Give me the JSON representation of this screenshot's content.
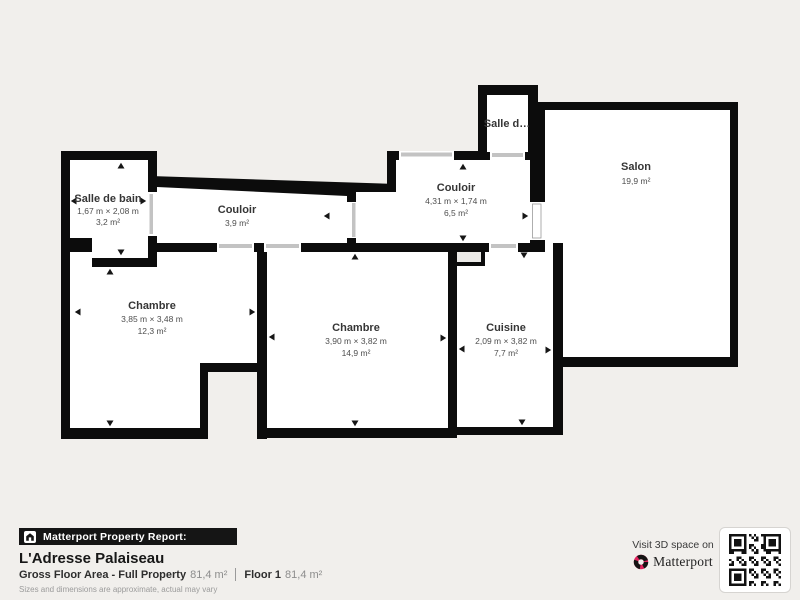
{
  "plan": {
    "rooms": {
      "salle_de_bain": {
        "name": "Salle de bain",
        "dims": "1,67 m × 2,08 m",
        "area": "3,2 m²"
      },
      "couloir_1": {
        "name": "Couloir",
        "area": "3,9 m²"
      },
      "couloir_2": {
        "name": "Couloir",
        "dims": "4,31 m × 1,74 m",
        "area": "6,5 m²"
      },
      "salle_d": {
        "name": "Salle d…"
      },
      "salon": {
        "name": "Salon",
        "area": "19,9 m²"
      },
      "chambre_1": {
        "name": "Chambre",
        "dims": "3,85 m × 3,48 m",
        "area": "12,3 m²"
      },
      "chambre_2": {
        "name": "Chambre",
        "dims": "3,90 m × 3,82 m",
        "area": "14,9 m²"
      },
      "cuisine": {
        "name": "Cuisine",
        "dims": "2,09 m × 3,82 m",
        "area": "7,7 m²"
      }
    },
    "colors": {
      "wall": "#0c0c0c",
      "room": "#ffffff",
      "outside": "#f1efec",
      "door_slot": "#c3c3c3"
    }
  },
  "footer": {
    "report_label": "Matterport Property Report:",
    "property_name": "L'Adresse Palaiseau",
    "gross_label": "Gross Floor Area - Full Property",
    "gross_value": "81,4 m²",
    "floor_label": "Floor 1",
    "floor_value": "81,4 m²",
    "disclaimer": "Sizes and dimensions are approximate, actual may vary",
    "visit_text": "Visit 3D space on",
    "brand": "Matterport"
  }
}
